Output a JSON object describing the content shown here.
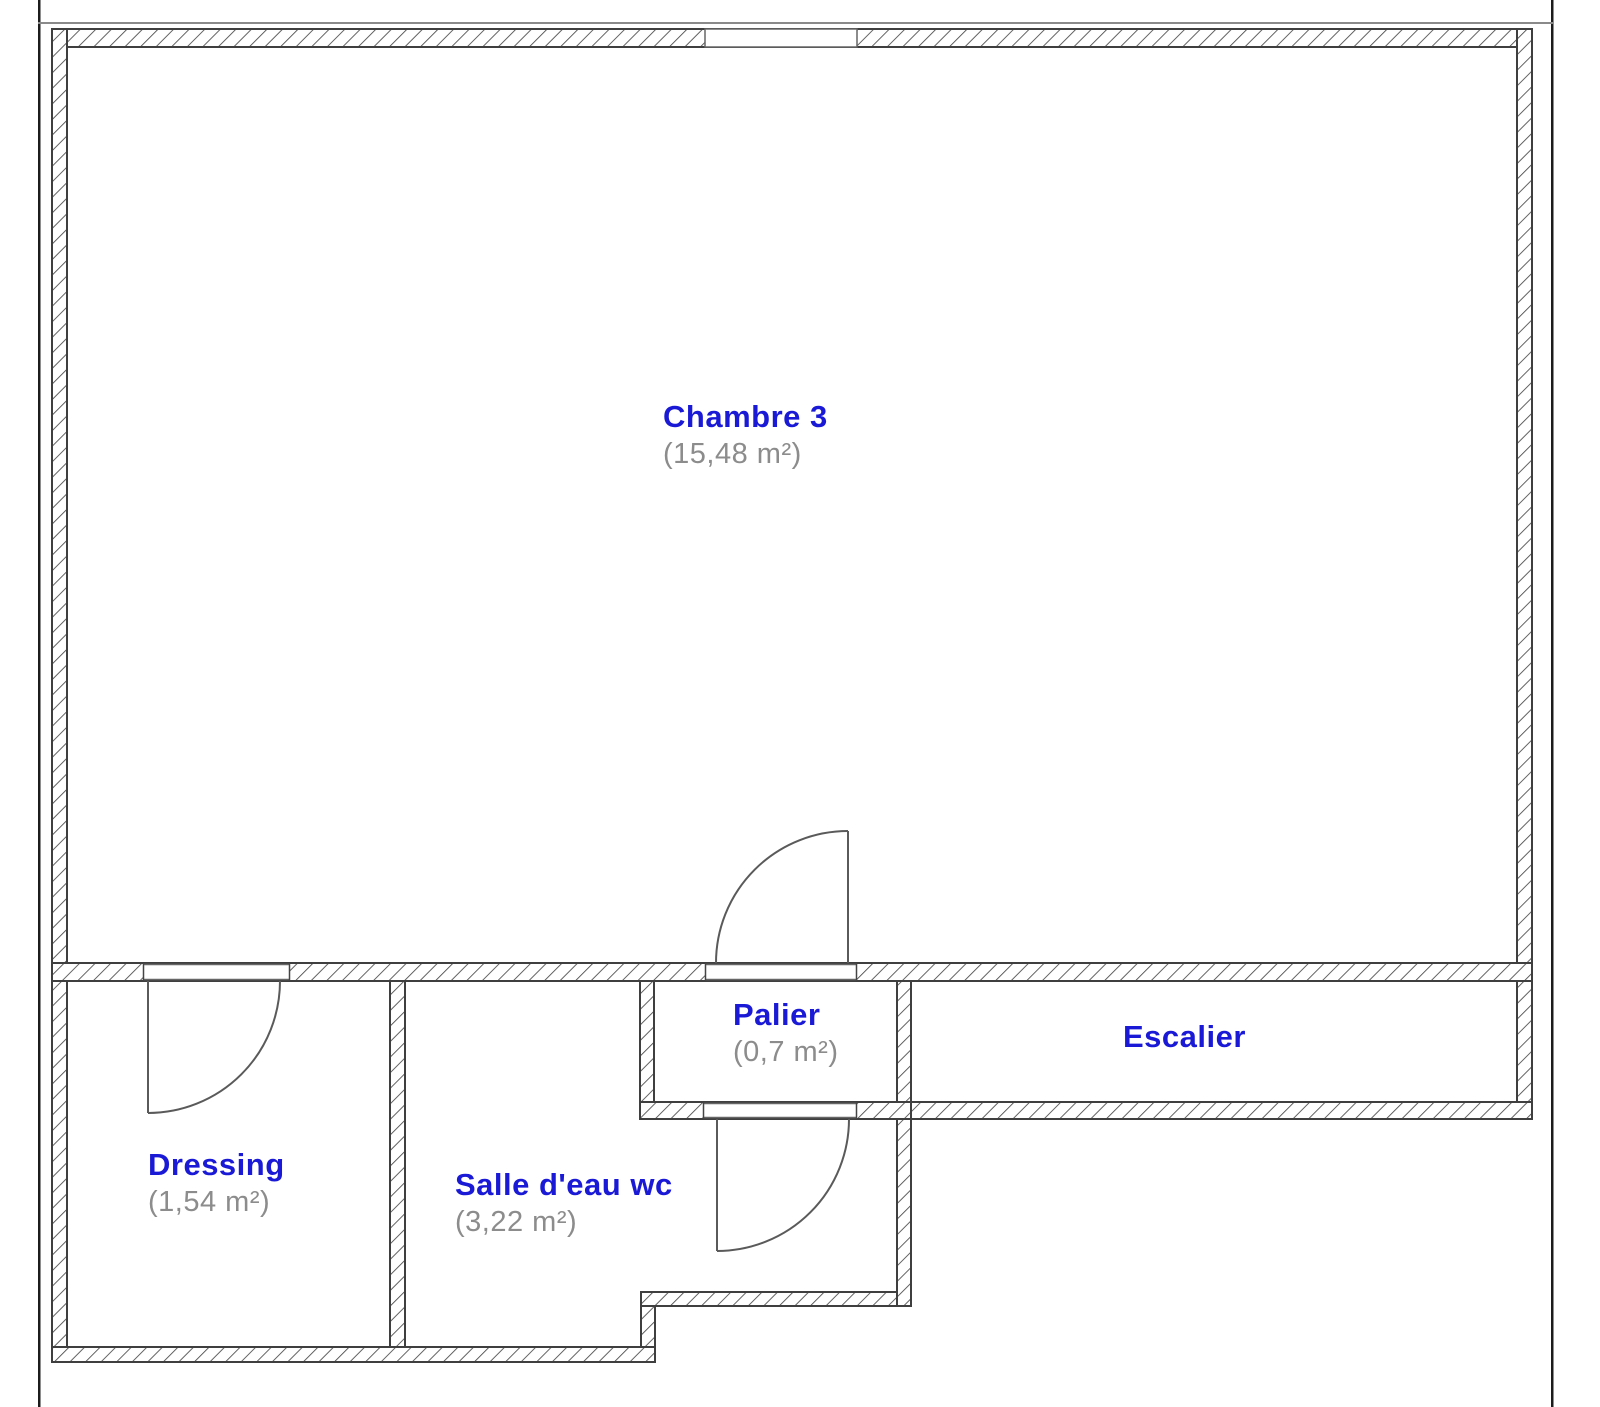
{
  "floorplan": {
    "rooms": [
      {
        "id": "chambre3",
        "name": "Chambre 3",
        "area": "(15,48 m²)"
      },
      {
        "id": "dressing",
        "name": "Dressing",
        "area": "(1,54 m²)"
      },
      {
        "id": "salle-eau",
        "name": "Salle d'eau wc",
        "area": "(3,22 m²)"
      },
      {
        "id": "palier",
        "name": "Palier",
        "area": "(0,7 m²)"
      },
      {
        "id": "escalier",
        "name": "Escalier",
        "area": ""
      }
    ],
    "colors": {
      "room_name_blue": "#1a1ad6",
      "room_area_gray": "#8c8c8c",
      "wall_line": "#3f3f3f",
      "door_line": "#5a5a5a",
      "frame_line": "#1c1c1c"
    }
  }
}
